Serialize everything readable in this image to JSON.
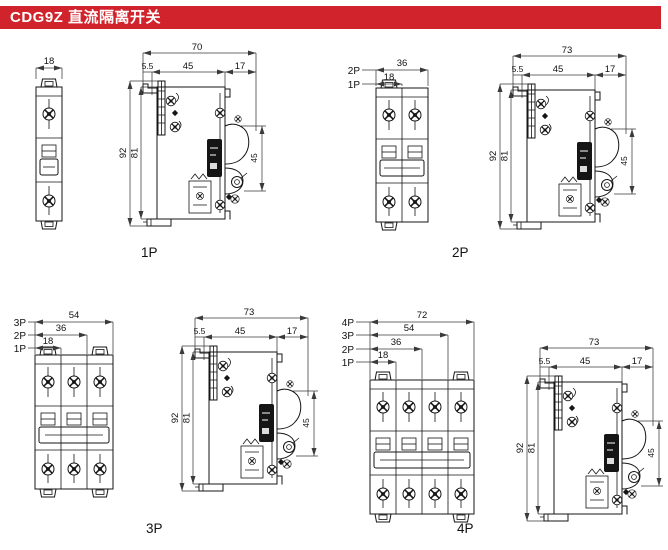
{
  "header": {
    "title": "CDG9Z 直流隔离开关"
  },
  "colors": {
    "header_bg": "#d0232b",
    "header_text": "#ffffff",
    "line": "#151515",
    "dim": "#3a3a3a"
  },
  "side_common": {
    "rear_offset": "5.5",
    "body_depth": "45",
    "handle_depth": "17",
    "overall_height": "92",
    "body_height": "81",
    "face_height": "45"
  },
  "panels": [
    {
      "label": "1P",
      "side": {
        "overall_depth": "70"
      },
      "front": {
        "poles": 1,
        "dims": [
          {
            "pole": "",
            "value": "18"
          }
        ]
      }
    },
    {
      "label": "2P",
      "side": {
        "overall_depth": "73"
      },
      "front": {
        "poles": 2,
        "dims": [
          {
            "pole": "2P",
            "value": "36"
          },
          {
            "pole": "1P",
            "value": "18"
          }
        ]
      }
    },
    {
      "label": "3P",
      "side": {
        "overall_depth": "73"
      },
      "front": {
        "poles": 3,
        "dims": [
          {
            "pole": "3P",
            "value": "54"
          },
          {
            "pole": "2P",
            "value": "36"
          },
          {
            "pole": "1P",
            "value": "18"
          }
        ]
      }
    },
    {
      "label": "4P",
      "side": {
        "overall_depth": "73"
      },
      "front": {
        "poles": 4,
        "dims": [
          {
            "pole": "4P",
            "value": "72"
          },
          {
            "pole": "3P",
            "value": "54"
          },
          {
            "pole": "2P",
            "value": "36"
          },
          {
            "pole": "1P",
            "value": "18"
          }
        ]
      }
    }
  ]
}
